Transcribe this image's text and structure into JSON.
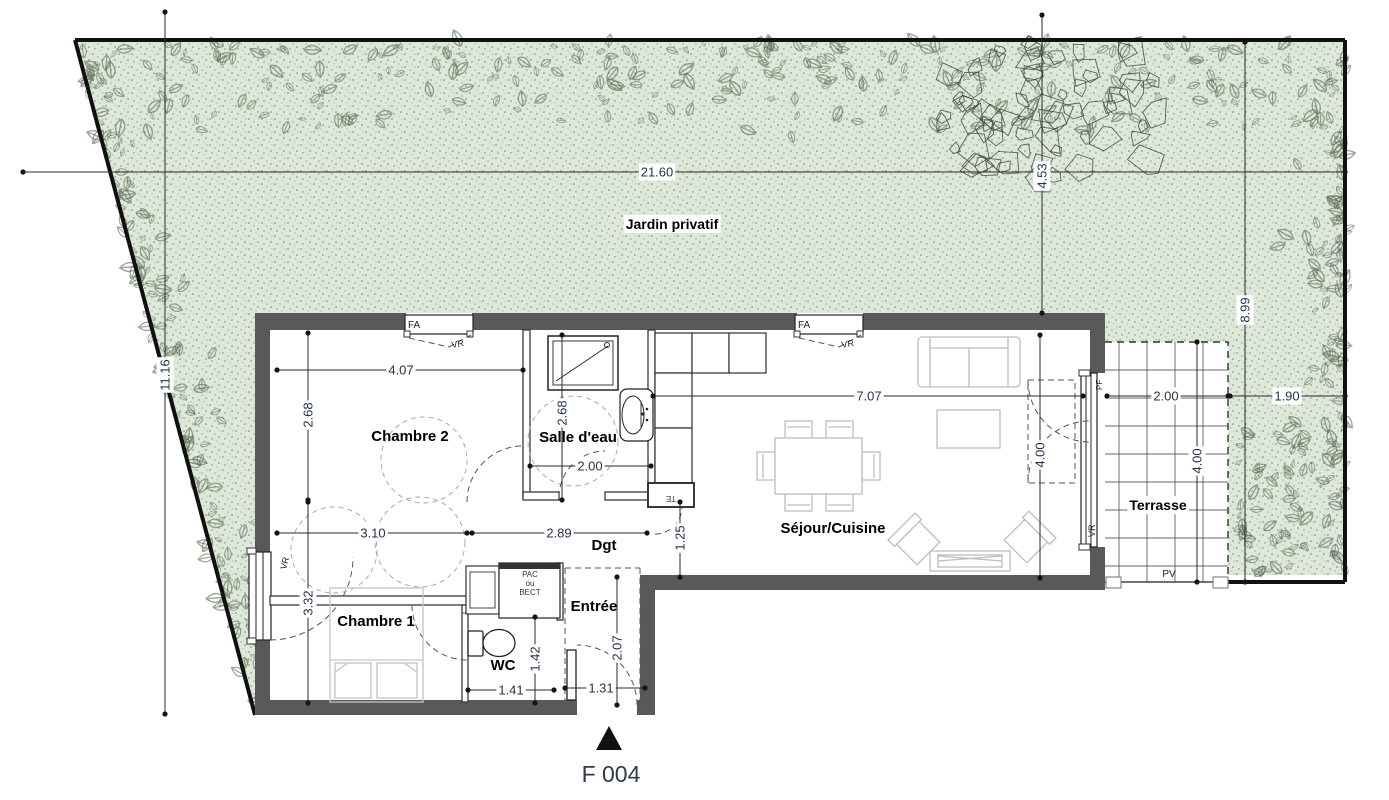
{
  "colors": {
    "garden": "#dde8d8",
    "wall": "#595959",
    "dim_text": "#26324a",
    "foliage": "#5c6c55"
  },
  "labels": {
    "garden": "Jardin privatif",
    "bedroom2": "Chambre 2",
    "bathroom": "Salle d'eau",
    "living": "Séjour/Cuisine",
    "bedroom1": "Chambre 1",
    "hallway": "Dgt",
    "entry": "Entrée",
    "wc": "WC",
    "terrace": "Terrasse",
    "unit": "F 004"
  },
  "dims": {
    "site_width": "21.60",
    "site_left": "11.16",
    "site_top_right": "4.53",
    "site_right": "8.99",
    "garden_right": "1.90",
    "bedroom2_w": "4.07",
    "bedroom2_h": "2.68",
    "bath_h": "2.68",
    "bath_w": "2.00",
    "living_w": "7.07",
    "living_h": "4.00",
    "bedroom1_w": "3.10",
    "hall_w": "2.89",
    "kitchen_pass": "1.25",
    "bedroom1_h": "3.32",
    "wc_w": "1.41",
    "wc_h": "1.42",
    "entry_w": "1.31",
    "entry_h": "2.07",
    "terrace_w": "2.00",
    "terrace_h": "4.00"
  },
  "tags": {
    "window": "FA",
    "shutter": "VR",
    "elec": "TE",
    "pv": "PV",
    "door_window": "PF"
  },
  "equipment": {
    "line1": "PAC",
    "line2": "ou",
    "line3": "BECT"
  }
}
